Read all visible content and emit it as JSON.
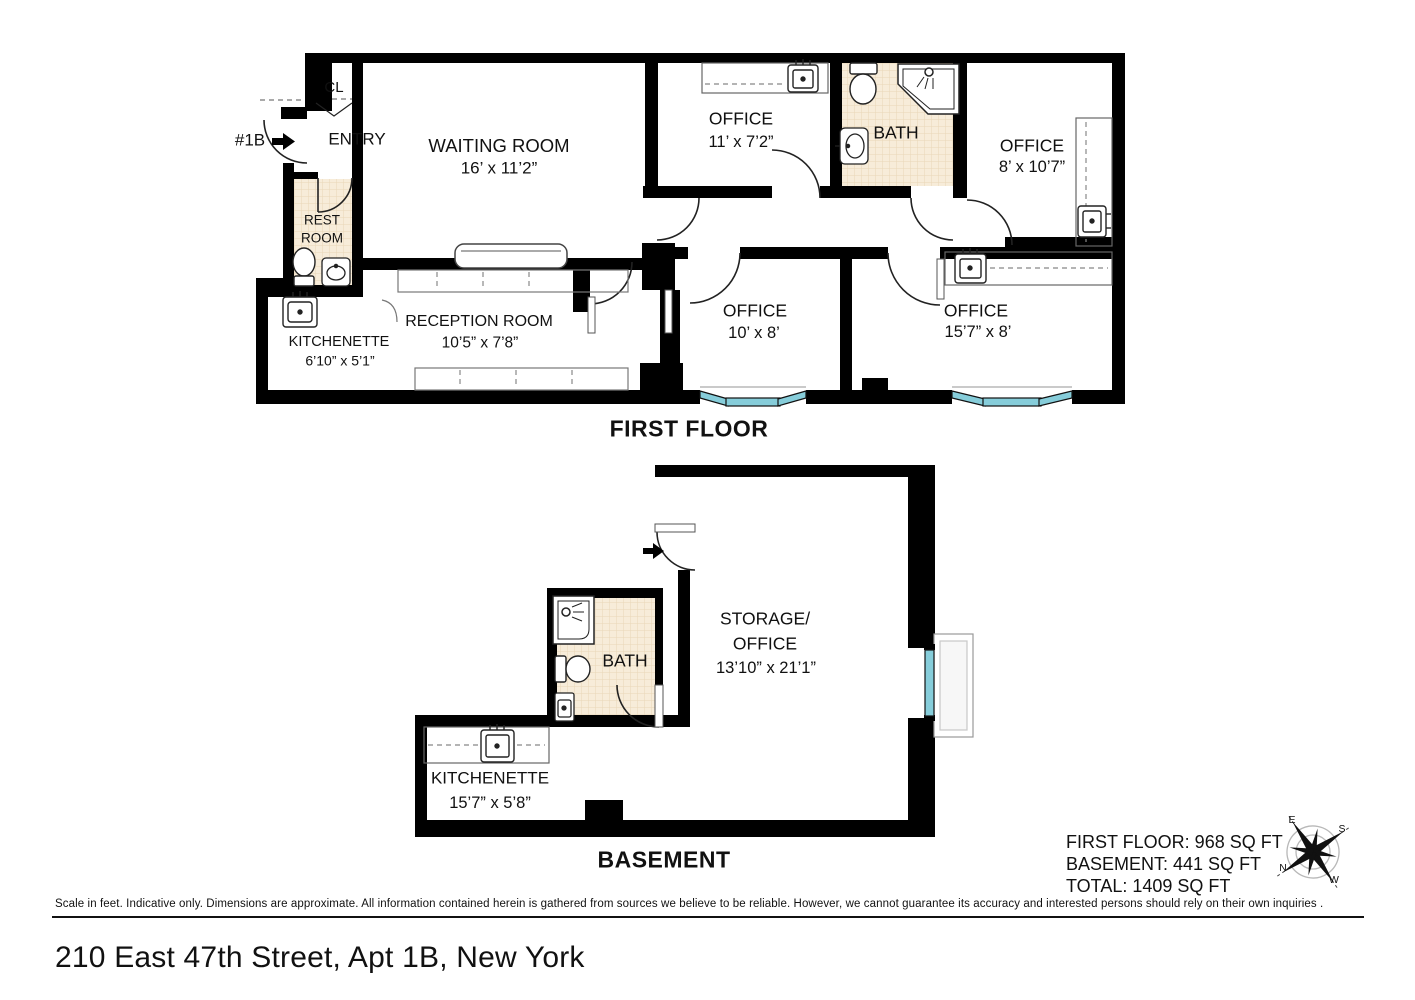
{
  "first_floor": {
    "title": "FIRST FLOOR",
    "unit_tag": "#1B",
    "closet": "CL",
    "entry": "ENTRY",
    "waiting_room": {
      "name": "WAITING ROOM",
      "dims": "16’ x 11’2”"
    },
    "office_1": {
      "name": "OFFICE",
      "dims": "11’ x 7’2”"
    },
    "bath": {
      "name": "BATH"
    },
    "office_2": {
      "name": "OFFICE",
      "dims": "8’ x 10’7”"
    },
    "rest_room": {
      "line1": "REST",
      "line2": "ROOM"
    },
    "reception_room": {
      "name": "RECEPTION ROOM",
      "dims": "10’5” x 7’8”"
    },
    "kitchenette": {
      "name": "KITCHENETTE",
      "dims": "6’10” x 5’1”"
    },
    "office_3": {
      "name": "OFFICE",
      "dims": "10’ x 8’"
    },
    "office_4": {
      "name": "OFFICE",
      "dims": "15’7” x 8’"
    }
  },
  "basement": {
    "title": "BASEMENT",
    "bath": {
      "name": "BATH"
    },
    "storage_office": {
      "line1": "STORAGE/",
      "line2": "OFFICE",
      "dims": "13’10” x 21’1”"
    },
    "kitchenette": {
      "name": "KITCHENETTE",
      "dims": "15’7” x 5’8”"
    }
  },
  "summary": {
    "first_floor": "FIRST FLOOR: 968 SQ FT",
    "basement": "BASEMENT: 441 SQ FT",
    "total": "TOTAL: 1409 SQ FT"
  },
  "compass": {
    "e": "E",
    "s": "S",
    "n": "N",
    "w": "W"
  },
  "footer": {
    "disclaimer": "Scale in feet. Indicative only. Dimensions are approximate. All information contained herein is gathered from sources we believe to be reliable. However, we cannot guarantee its accuracy and interested persons should rely on their own inquiries .",
    "address": "210 East 47th Street, Apt 1B, New York"
  },
  "colors": {
    "wall": "#000000",
    "window": "#86cdda",
    "tile": "#f7ecd9"
  }
}
